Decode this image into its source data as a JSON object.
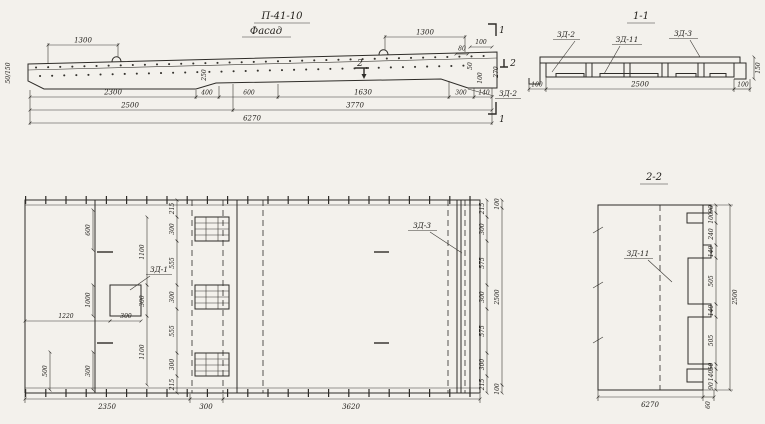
{
  "facade": {
    "title": "П-41-10",
    "subtitle": "Фасад",
    "label_zd2": "ЗД-2",
    "cut_marks": {
      "one_top": "1",
      "one_bottom": "1",
      "two_mid": "2",
      "two_right": "2"
    },
    "dims": {
      "top_left": "1300",
      "top_right": "1300",
      "end_80": "80",
      "end_100_top": "100",
      "end_50": "50",
      "end_100": "100",
      "end_270": "270",
      "step_250": "250",
      "left_height": "50/150",
      "row1": [
        "2300",
        "400",
        "600",
        "1630",
        "300",
        "140"
      ],
      "row2": [
        "2500",
        "3770"
      ],
      "total": "6270"
    }
  },
  "section11": {
    "title": "1-1",
    "label_zd2": "ЗД-2",
    "label_zd11": "ЗД-11",
    "label_zd3": "ЗД-3",
    "dim_left": "100",
    "dim_mid": "2500",
    "dim_right": "100",
    "dim_height": "150"
  },
  "plan": {
    "label_zd1": "ЗД-1",
    "label_zd3": "ЗД-3",
    "dim_1220": "1220",
    "dim_300_sq": "300",
    "left_chain": [
      "600",
      "1000",
      "300"
    ],
    "left_500": "500",
    "inner_chain": [
      "1100",
      "300",
      "1100"
    ],
    "mid_chain": [
      "215",
      "300",
      "555",
      "300",
      "555",
      "300",
      "215"
    ],
    "right_chain": [
      "215",
      "300",
      "575",
      "300",
      "575",
      "300",
      "215"
    ],
    "right_outer": [
      "100",
      "2500",
      "100"
    ],
    "bottom_chain": [
      "2350",
      "300",
      "3620"
    ]
  },
  "section22": {
    "title": "2-2",
    "label_zd11": "ЗД-11",
    "right_chain": [
      "90",
      "100",
      "240",
      "140",
      "505",
      "140",
      "505",
      "50",
      "140",
      "90"
    ],
    "total": "2500",
    "bottom": "6270",
    "bottom_60": "60"
  }
}
